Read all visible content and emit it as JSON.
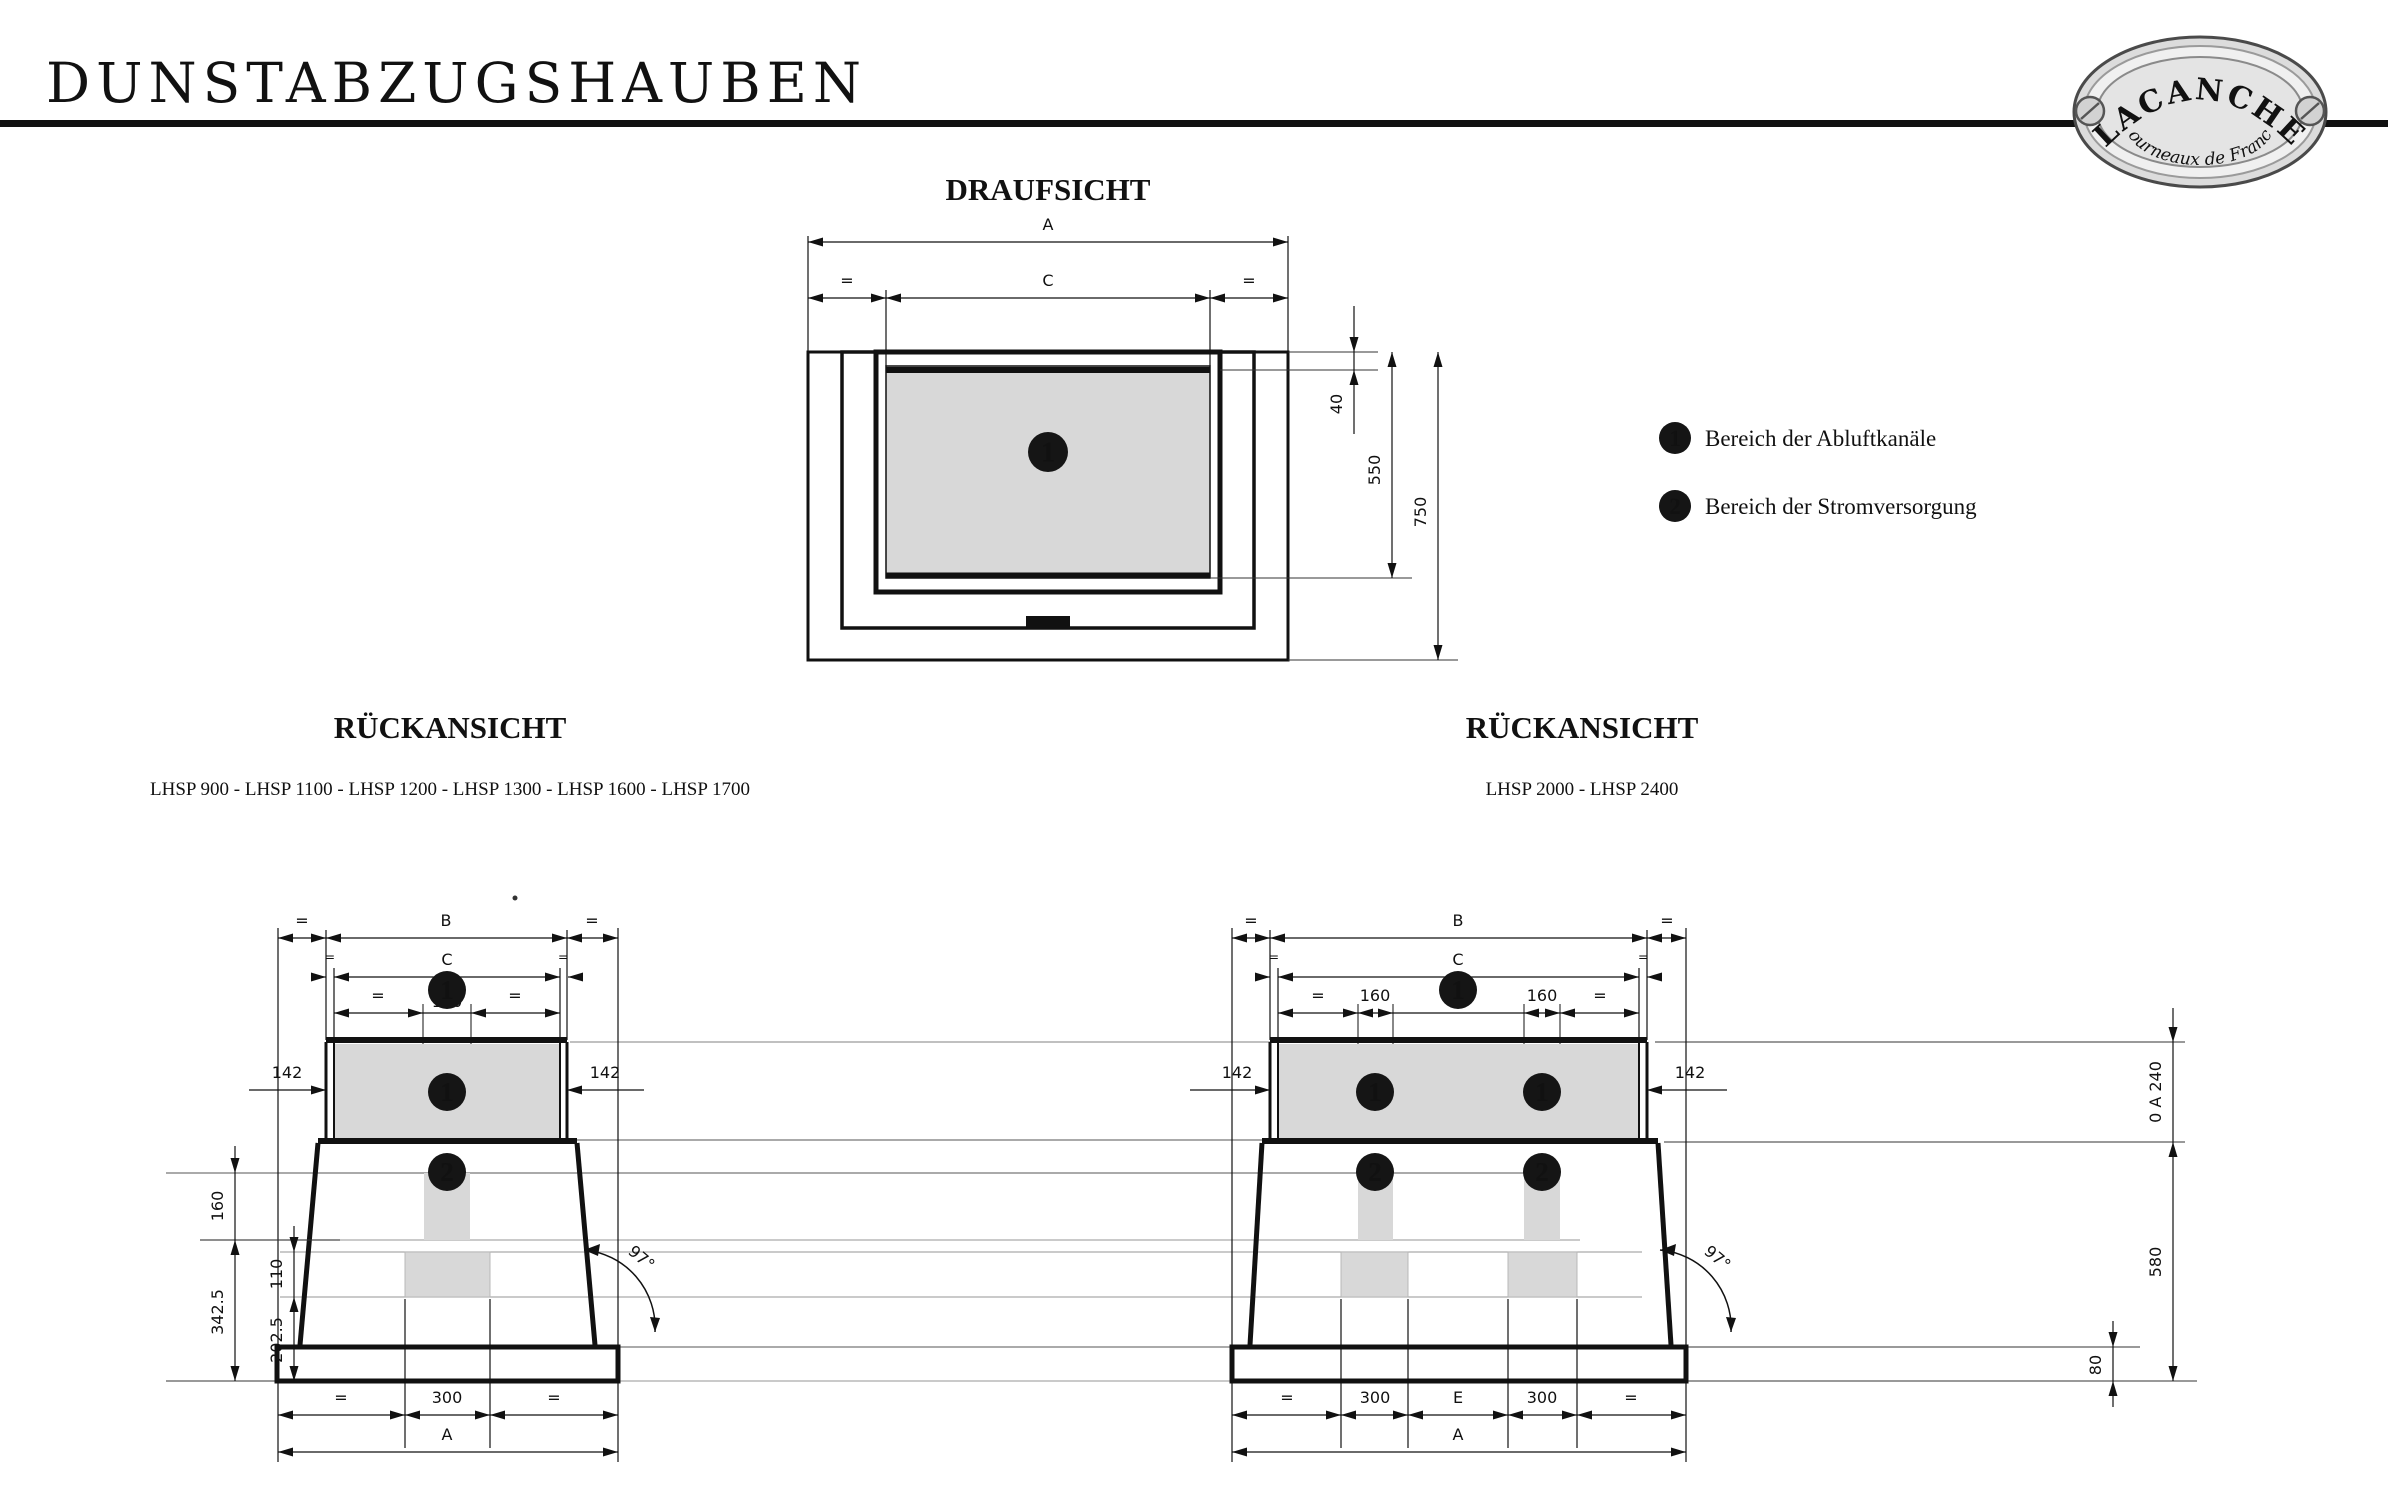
{
  "header": {
    "title": "DUNSTABZUGSHAUBEN"
  },
  "logo": {
    "brand": "LACANCHE",
    "tagline": "Fourneaux de France"
  },
  "legend": {
    "items": [
      {
        "marker": "1",
        "label": "Bereich der Abluftkanäle"
      },
      {
        "marker": "2",
        "label": "Bereich der Stromversorgung"
      }
    ]
  },
  "top_view": {
    "title": "DRAUFSICHT",
    "badge": "1",
    "dims": {
      "a": "A",
      "c": "C",
      "eq": "=",
      "d40": "40",
      "d550": "550",
      "d750": "750"
    }
  },
  "left_view": {
    "title": "RÜCKANSICHT",
    "models": "LHSP 900 - LHSP 1100 - LHSP 1200 - LHSP 1300 - LHSP 1600 - LHSP 1700",
    "badge_duct": "1",
    "badge_power": "2",
    "dims": {
      "a": "A",
      "b": "B",
      "c": "C",
      "eq": "=",
      "c160": "160",
      "d142": "142",
      "d300": "300",
      "v160": "160",
      "v110": "110",
      "v342_5": "342.5",
      "v202_5": "202.5",
      "angle": "97°"
    }
  },
  "right_view": {
    "title": "RÜCKANSICHT",
    "models": "LHSP 2000 - LHSP 2400",
    "badge_duct": "1",
    "badge_power": "2",
    "dims": {
      "a": "A",
      "b": "B",
      "c": "C",
      "d": "D",
      "e": "E",
      "eq": "=",
      "d160": "160",
      "d142": "142",
      "d300": "300",
      "v240": "0 A 240",
      "v580": "580",
      "v80": "80",
      "angle": "97°"
    }
  }
}
